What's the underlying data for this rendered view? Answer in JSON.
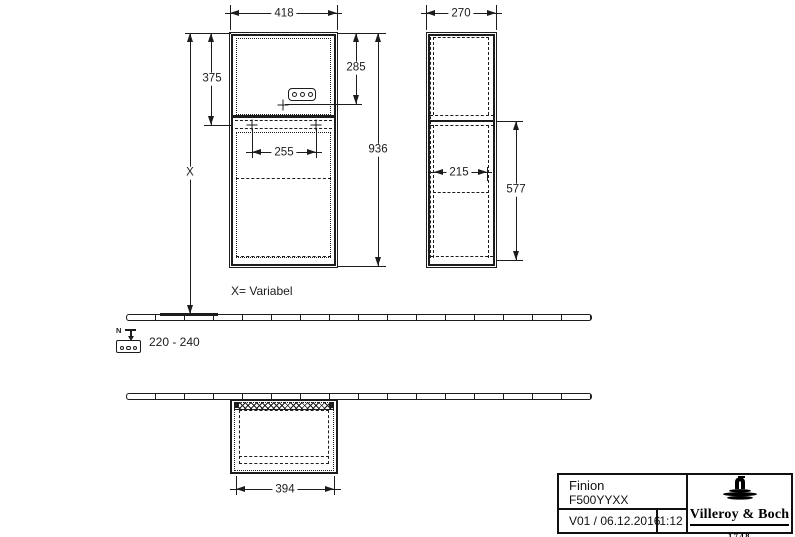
{
  "dimensions": {
    "front_width": "418",
    "depth": "270",
    "upper_height": "375",
    "socket_height": "285",
    "total_height": "936",
    "hanger_spacing": "255",
    "inner_depth": "215",
    "lower_height": "577",
    "plan_width": "394",
    "variable": "X",
    "variable_note": "X= Variabel"
  },
  "electrical": {
    "n_label": "N",
    "voltage": "220 - 240"
  },
  "titleblock": {
    "product": "Finion",
    "article": "F500YYXX",
    "version_date": "V01 / 06.12.2016",
    "scale": "1:12",
    "brand": "Villeroy & Boch",
    "year": "1748"
  },
  "colors": {
    "line": "#1c1c1c",
    "background": "#ffffff"
  }
}
